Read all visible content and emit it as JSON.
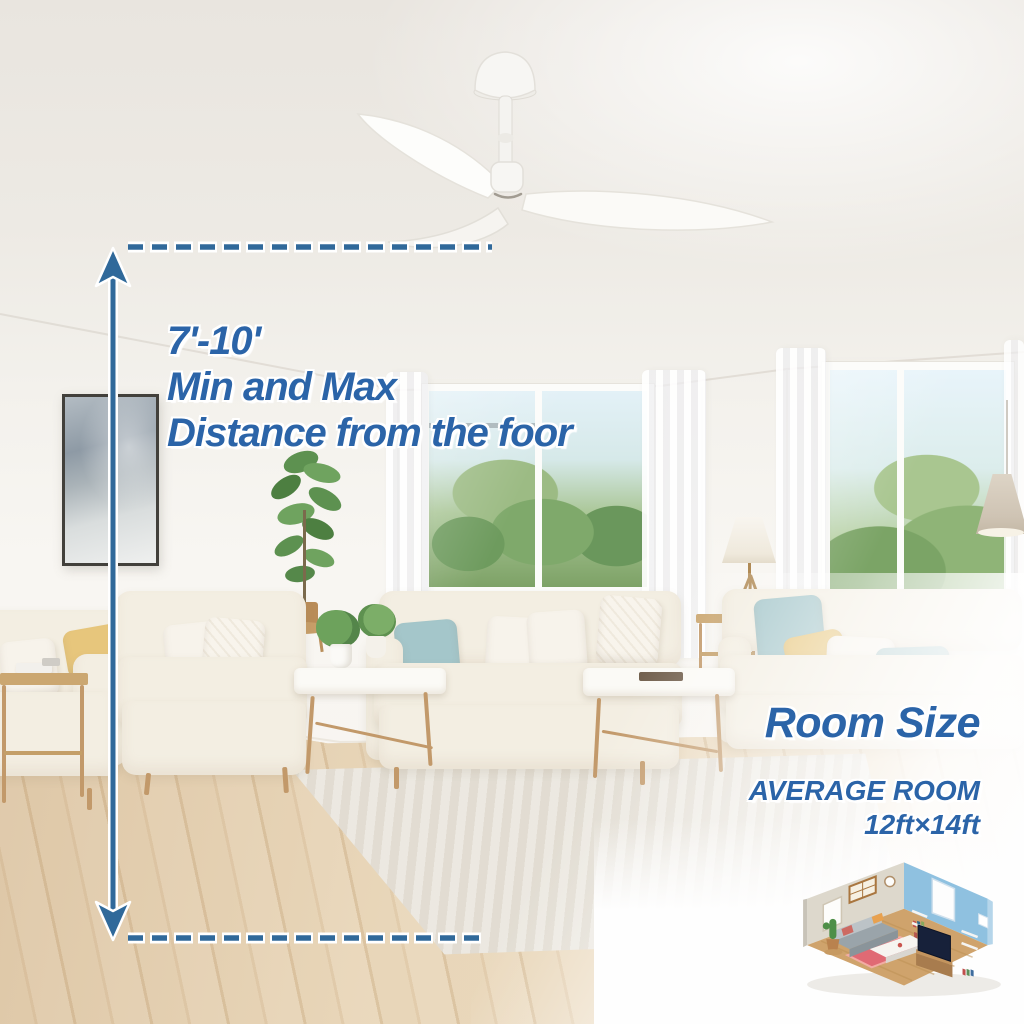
{
  "annotation": {
    "line1": "7'-10'",
    "line2": "Min and Max",
    "line3": "Distance from the foor"
  },
  "room_size": {
    "title": "Room Size",
    "subtitle": "AVERAGE ROOM",
    "dimensions": "12ft×14ft"
  },
  "colors": {
    "text_blue": "#2b64a8",
    "measure_blue": "#30699a"
  }
}
